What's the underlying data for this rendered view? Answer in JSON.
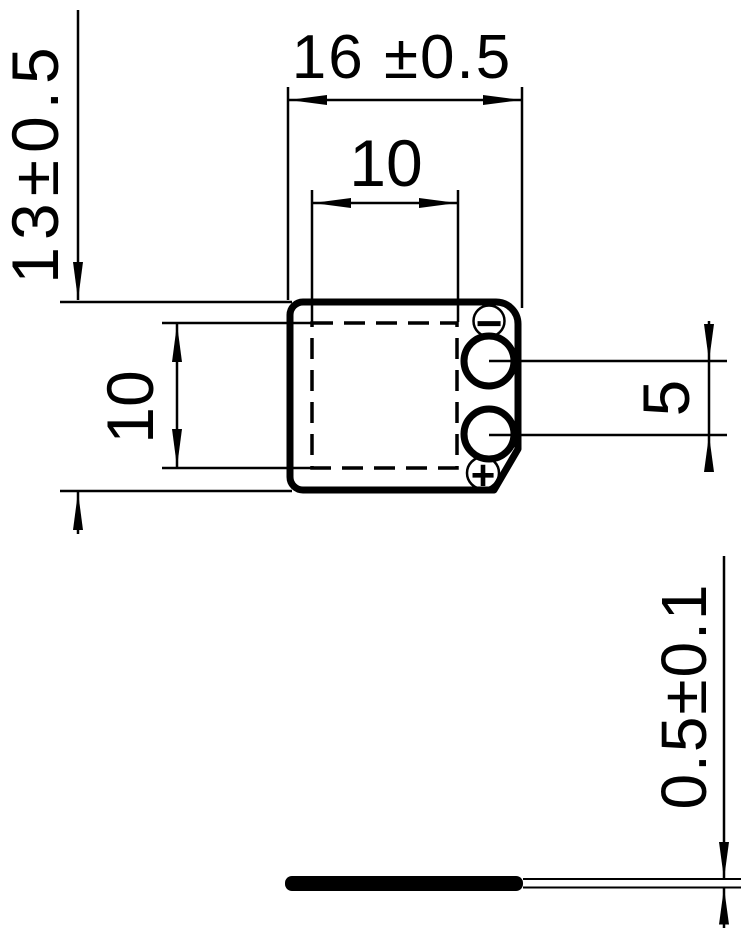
{
  "drawing": {
    "ink_color": "#000000",
    "paper_color": "#ffffff",
    "top_view": {
      "dim_body_width": "16 ±0.5",
      "dim_inner_width": "10",
      "dim_body_height": "13±0.5",
      "dim_inner_height": "10",
      "dim_pad_spacing": "5",
      "negative_mark": "−",
      "positive_mark": "+"
    },
    "side_view": {
      "dim_thickness": "0.5±0.1"
    }
  }
}
